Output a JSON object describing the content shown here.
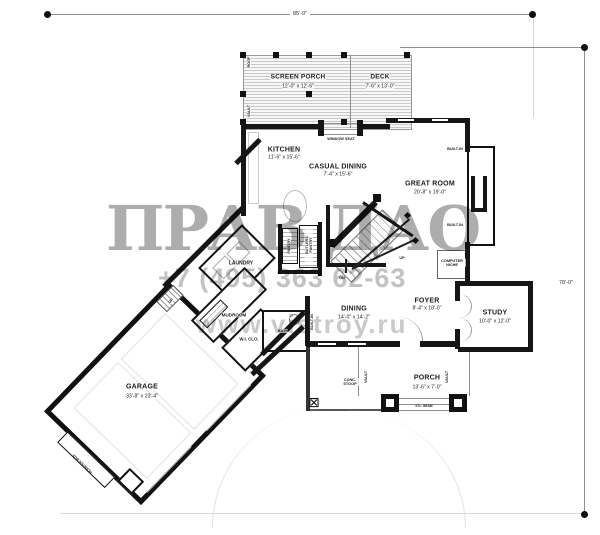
{
  "sheet": {
    "width_dim": "85'-9\"",
    "height_dim": "78'-0\""
  },
  "watermark": {
    "brand": "ПРАВ ДАО",
    "phone": "+7 (495) 363 62-63",
    "site": "www.vistroy.ru"
  },
  "rooms": [
    {
      "name": "SCREEN PORCH",
      "dim": "12'-0\" x 12'-6\""
    },
    {
      "name": "DECK",
      "dim": "7'-6\" x 13'-0\""
    },
    {
      "name": "KITCHEN",
      "dim": "11'-6\" x 15'-6\""
    },
    {
      "name": "CASUAL DINING",
      "dim": "7'-4\" x 15'-6\""
    },
    {
      "name": "GREAT ROOM",
      "dim": "20'-8\" x 19'-0\""
    },
    {
      "name": "DINING",
      "dim": "14'-0\" x 14'-2\""
    },
    {
      "name": "FOYER",
      "dim": "8'-4\" x 18'-0\""
    },
    {
      "name": "STUDY",
      "dim": "10'-0\" x 12'-0\""
    },
    {
      "name": "PORCH",
      "dim": "13'-6\" x 7'-0\""
    },
    {
      "name": "GARAGE",
      "dim": "33'-8\" x 23'-4\""
    }
  ],
  "labels": {
    "laundry": "LAUNDRY",
    "mudroom": "MUDROOM",
    "wi_clo": "W.I. CLO.",
    "bath": "BATH",
    "pantry": "PANTRY",
    "butlers_pantry": "BUTLERS PANTRY",
    "built_in": "BUILT-IN",
    "computer_niche": "COMPUTER NICHE",
    "window_seat": "WINDOW SEAT",
    "conc_stoop": "CONC. STOOP",
    "vault": "VAULT",
    "roof": "ROOF",
    "up": "UP",
    "dn": "DN",
    "planter_box": "PLANTER BOX",
    "beam_note": "STL. BEAM"
  }
}
